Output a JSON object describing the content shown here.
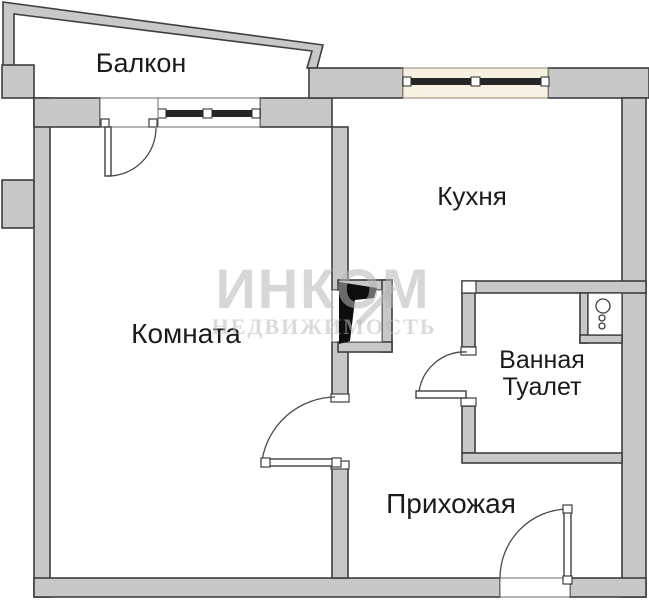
{
  "page": {
    "type": "apartment-floor-plan",
    "background": "#ffffff"
  },
  "colors": {
    "wall_fill": "#c8c8c8",
    "wall_outline": "#3e3e3e",
    "window_bar": "#262626",
    "open_door_leaf": "#0e0e0e",
    "kitchen_window_tint": "#f6f1e2",
    "label_text": "#1b1b1b",
    "watermark": "#b7b7b7"
  },
  "rooms": [
    {
      "id": "balcony",
      "label": "Балкон"
    },
    {
      "id": "kitchen",
      "label": "Кухня"
    },
    {
      "id": "living-room",
      "label": "Комната"
    },
    {
      "id": "bathroom",
      "label": "Ванная Туалет",
      "label_lines": [
        "Ванная",
        "Туалет"
      ]
    },
    {
      "id": "hallway",
      "label": "Прихожая"
    }
  ],
  "watermark": {
    "brand": "ИНКОМ",
    "tagline": "НЕДВИЖИМОСТЬ"
  },
  "doors": [
    {
      "name": "balcony-door",
      "between": [
        "Комната",
        "Балкон"
      ]
    },
    {
      "name": "kitchen-door-open-black-leaf",
      "between": [
        "Прихожая",
        "Кухня"
      ]
    },
    {
      "name": "living-room-door",
      "between": [
        "Прихожая",
        "Комната"
      ]
    },
    {
      "name": "bathroom-door",
      "between": [
        "Прихожая",
        "Ванная Туалет"
      ]
    },
    {
      "name": "entrance-door",
      "between": [
        "снаружи",
        "Прихожая"
      ]
    }
  ],
  "windows": [
    {
      "name": "balcony-window",
      "wall": "top",
      "room": "Комната"
    },
    {
      "name": "kitchen-window",
      "wall": "top",
      "room": "Кухня"
    }
  ],
  "fixtures": [
    {
      "name": "ventilation-shaft-sink-symbol",
      "room": "Ванная Туалет",
      "circles": 3
    }
  ]
}
